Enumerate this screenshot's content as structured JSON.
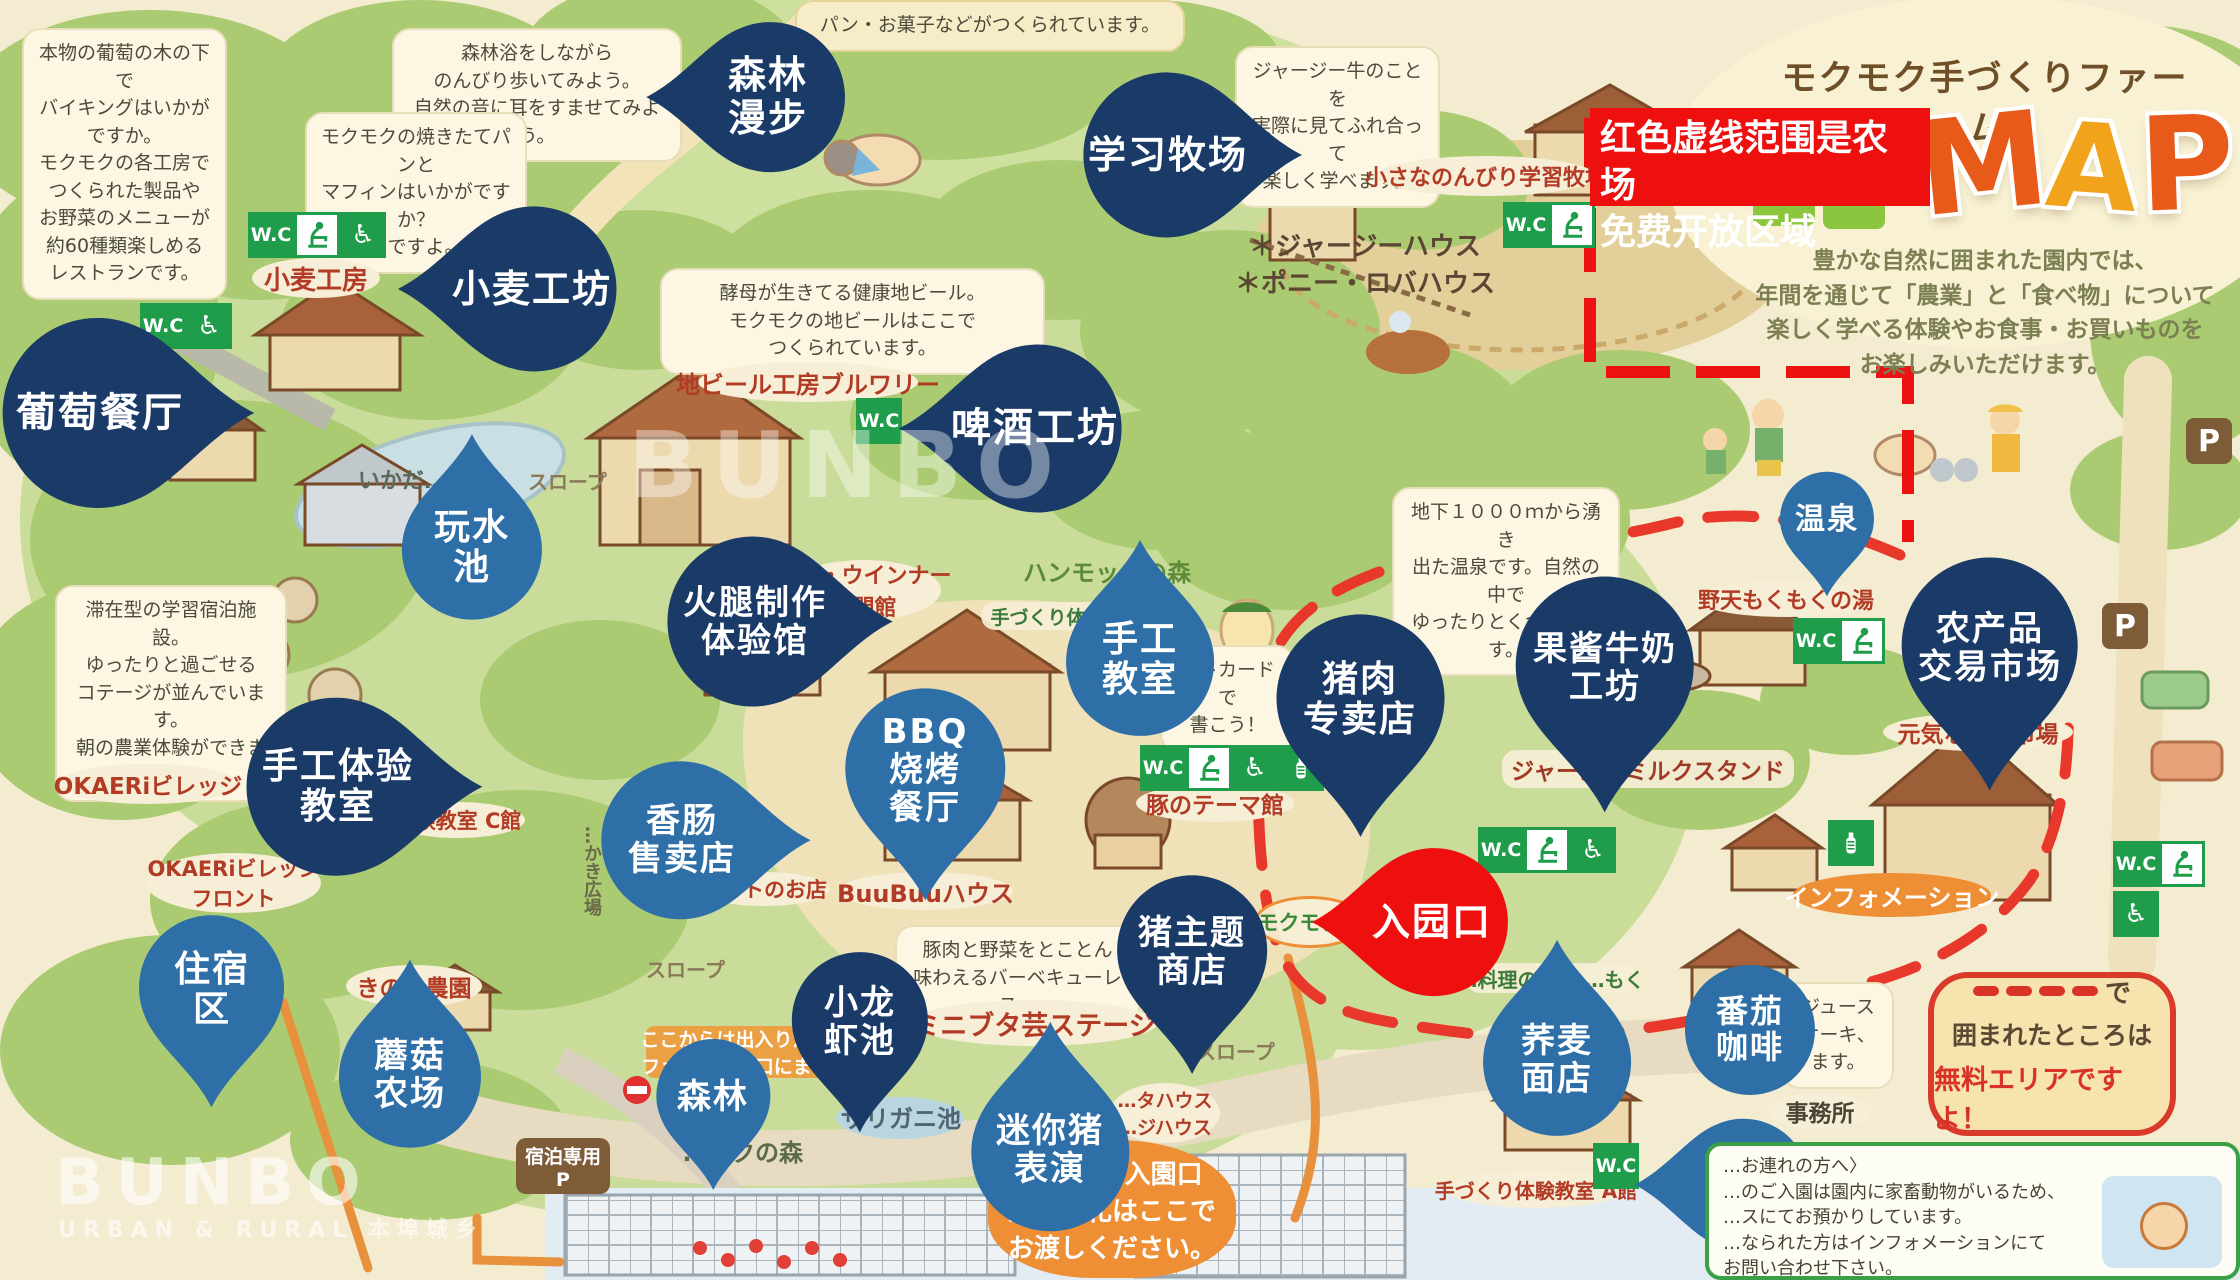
{
  "colors": {
    "pin_navy": "#1a3a68",
    "pin_light": "#2e6fa8",
    "pin_red": "#ee0f0f",
    "wc_green": "#1f9d4a",
    "orange": "#ef8f35",
    "map_red": "#e8372b",
    "cream": "#f4ecd1"
  },
  "title": {
    "farm": "モクモク手づくりファーム",
    "map_letters": [
      "M",
      "A",
      "P"
    ],
    "intro": [
      "豊かな自然に囲まれた園内では、",
      "年間を通じて「農業」と「食べ物」について",
      "楽しく学べる体験やお食事・お買いものを",
      "お楽しみいただけます。"
    ]
  },
  "red_notice": {
    "lines": [
      "红色虚线范围是农场",
      "免费开放区域"
    ]
  },
  "free_callout": {
    "line1_suffix": "で",
    "line2": "囲まれたところは",
    "line3": "無料エリアですよ！"
  },
  "pet_notice": {
    "lines": [
      "…お連れの方へ〉",
      "…のご入園は園内に家畜動物がいるため、",
      "…スにてお預かりしています。",
      "…なられた方はインフォメーションにて",
      "お問い合わせ下さい。"
    ]
  },
  "watermarks": {
    "center": "BUNBO",
    "corner": "BUNBO",
    "corner_sub": "URBAN & RURAL 本埠城乡"
  },
  "pins": [
    {
      "id": "grape-restaurant",
      "lines": [
        "葡萄餐厅"
      ],
      "cx": 100,
      "cy": 413,
      "d": 190,
      "dir": "right",
      "style": "navy",
      "fs": 40
    },
    {
      "id": "wheat-workshop",
      "lines": [
        "小麦工坊"
      ],
      "cx": 532,
      "cy": 289,
      "d": 165,
      "dir": "left",
      "style": "navy",
      "fs": 38
    },
    {
      "id": "forest-walk",
      "lines": [
        "森林",
        "漫步"
      ],
      "cx": 768,
      "cy": 97,
      "d": 150,
      "dir": "left",
      "style": "navy",
      "fs": 38
    },
    {
      "id": "learning-ranch",
      "lines": [
        "学习牧场"
      ],
      "cx": 1168,
      "cy": 155,
      "d": 165,
      "dir": "right",
      "style": "navy",
      "fs": 38
    },
    {
      "id": "beer-workshop",
      "lines": [
        "啤酒工坊"
      ],
      "cx": 1035,
      "cy": 428,
      "d": 168,
      "dir": "left",
      "style": "navy",
      "fs": 40
    },
    {
      "id": "ham-workshop",
      "lines": [
        "火腿制作",
        "体验馆"
      ],
      "cx": 755,
      "cy": 622,
      "d": 170,
      "dir": "right",
      "style": "navy",
      "fs": 34
    },
    {
      "id": "water-pond",
      "lines": [
        "玩水",
        "池"
      ],
      "cx": 472,
      "cy": 548,
      "d": 140,
      "dir": "up",
      "style": "light",
      "fs": 36
    },
    {
      "id": "craft-class-center",
      "lines": [
        "手工",
        "教室"
      ],
      "cx": 1140,
      "cy": 660,
      "d": 148,
      "dir": "up",
      "style": "light",
      "fs": 36
    },
    {
      "id": "bbq-restaurant",
      "lines": [
        "BBQ",
        "烧烤",
        "餐厅"
      ],
      "cx": 925,
      "cy": 770,
      "d": 160,
      "dir": "down",
      "style": "light",
      "fs": 34
    },
    {
      "id": "sausage-shop",
      "lines": [
        "香肠",
        "售卖店"
      ],
      "cx": 682,
      "cy": 840,
      "d": 158,
      "dir": "right",
      "style": "light",
      "fs": 34
    },
    {
      "id": "craft-experience-class",
      "lines": [
        "手工体验",
        "教室"
      ],
      "cx": 338,
      "cy": 787,
      "d": 178,
      "dir": "right",
      "style": "navy",
      "fs": 36
    },
    {
      "id": "pork-shop",
      "lines": [
        "猪肉",
        "专卖店"
      ],
      "cx": 1360,
      "cy": 700,
      "d": 168,
      "dir": "down",
      "style": "navy",
      "fs": 36
    },
    {
      "id": "jam-milk-workshop",
      "lines": [
        "果酱牛奶",
        "工坊"
      ],
      "cx": 1605,
      "cy": 668,
      "d": 178,
      "dir": "down",
      "style": "navy",
      "fs": 34
    },
    {
      "id": "hot-spring",
      "lines": [
        "温泉"
      ],
      "cx": 1827,
      "cy": 520,
      "d": 94,
      "dir": "down",
      "style": "light",
      "fs": 30
    },
    {
      "id": "farm-produce-market",
      "lines": [
        "农产品",
        "交易市场"
      ],
      "cx": 1990,
      "cy": 648,
      "d": 176,
      "dir": "down",
      "style": "navy",
      "fs": 34
    },
    {
      "id": "entrance",
      "lines": [
        "入园口"
      ],
      "cx": 1432,
      "cy": 922,
      "d": 148,
      "dir": "left",
      "style": "red",
      "fs": 38
    },
    {
      "id": "pig-theme-store",
      "lines": [
        "猪主题",
        "商店"
      ],
      "cx": 1192,
      "cy": 952,
      "d": 150,
      "dir": "down",
      "style": "navy",
      "fs": 34
    },
    {
      "id": "lodging-area",
      "lines": [
        "住宿",
        "区"
      ],
      "cx": 212,
      "cy": 990,
      "d": 145,
      "dir": "down",
      "style": "light",
      "fs": 36
    },
    {
      "id": "mushroom-farm",
      "lines": [
        "蘑菇",
        "农场"
      ],
      "cx": 410,
      "cy": 1075,
      "d": 142,
      "dir": "up",
      "style": "light",
      "fs": 34
    },
    {
      "id": "forest",
      "lines": [
        "森林"
      ],
      "cx": 713,
      "cy": 1097,
      "d": 114,
      "dir": "down",
      "style": "light",
      "fs": 34
    },
    {
      "id": "crayfish-pond",
      "lines": [
        "小龙",
        "虾池"
      ],
      "cx": 860,
      "cy": 1022,
      "d": 136,
      "dir": "down",
      "style": "navy",
      "fs": 34
    },
    {
      "id": "mini-pig-show",
      "lines": [
        "迷你猪",
        "表演"
      ],
      "cx": 1050,
      "cy": 1150,
      "d": 158,
      "dir": "up",
      "style": "light",
      "fs": 34
    },
    {
      "id": "soba-shop",
      "lines": [
        "荞麦",
        "面店"
      ],
      "cx": 1557,
      "cy": 1060,
      "d": 148,
      "dir": "up",
      "style": "light",
      "fs": 34
    },
    {
      "id": "tomato-coffee",
      "lines": [
        "番茄",
        "咖啡"
      ],
      "cx": 1750,
      "cy": 1030,
      "d": 130,
      "dir": "none",
      "style": "light",
      "fs": 32
    },
    {
      "id": "craft-class-br",
      "lines": [
        "手工",
        "教室"
      ],
      "cx": 1742,
      "cy": 1185,
      "d": 132,
      "dir": "left",
      "style": "light",
      "fs": 32
    }
  ],
  "bubbles": [
    {
      "x": 22,
      "y": 28,
      "w": 205,
      "tone": "cream",
      "lines": [
        "本物の葡萄の木の下で",
        "バイキングはいかがですか。",
        "モクモクの各工房で",
        "つくられた製品や",
        "お野菜のメニューが",
        "約60種類楽しめる",
        "レストランです。"
      ]
    },
    {
      "x": 392,
      "y": 28,
      "w": 290,
      "tone": "cream",
      "lines": [
        "森林浴をしながら",
        "のんびり歩いてみよう。",
        "自然の音に耳をすませてみよう。"
      ]
    },
    {
      "x": 795,
      "y": 0,
      "w": 390,
      "tone": "yellow",
      "lines": [
        "パン・お菓子などがつくられています。"
      ]
    },
    {
      "x": 305,
      "y": 112,
      "w": 222,
      "tone": "cream",
      "lines": [
        "モクモクの焼きたてパンと",
        "マフィンはいかがですか？",
        "…ですよ。"
      ]
    },
    {
      "x": 660,
      "y": 268,
      "w": 385,
      "tone": "cream",
      "lines": [
        "酵母が生きてる健康地ビール。",
        "モクモクの地ビールはここで",
        "つくられています。"
      ]
    },
    {
      "x": 1235,
      "y": 46,
      "w": 205,
      "tone": "cream",
      "lines": [
        "ジャージー牛のことを",
        "実際に見てふれ合って",
        "楽しく学べます。"
      ]
    },
    {
      "x": 55,
      "y": 585,
      "w": 232,
      "tone": "cream",
      "lines": [
        "滞在型の学習宿泊施設。",
        "ゆったりと過ごせる",
        "コテージが並んでいます。",
        "朝の農業体験ができます。"
      ]
    },
    {
      "x": 1392,
      "y": 487,
      "w": 228,
      "tone": "cream",
      "lines": [
        "地下１０００ｍから湧き",
        "出た温泉です。自然の中で",
        "ゆったりとくつろげます。"
      ]
    },
    {
      "x": 1160,
      "y": 645,
      "w": 135,
      "tone": "cream",
      "lines": [
        "ストカードで",
        "書こう！"
      ]
    },
    {
      "x": 895,
      "y": 925,
      "w": 245,
      "tone": "cream",
      "lines": [
        "豚肉と野菜をとことん",
        "味わえるバーベキューレス…"
      ]
    },
    {
      "x": 1782,
      "y": 982,
      "w": 112,
      "tone": "cream",
      "lines": [
        "ジュース",
        "ケーキ、",
        "ます。"
      ]
    }
  ],
  "labels": [
    {
      "type": "oval",
      "x": 252,
      "y": 258,
      "w": 128,
      "h": 40,
      "fs": 26,
      "lines": [
        "小麦工房"
      ]
    },
    {
      "type": "oval",
      "x": 698,
      "y": 362,
      "w": 220,
      "h": 40,
      "fs": 24,
      "lines": [
        "地ビール工房ブルワリー"
      ]
    },
    {
      "type": "oval",
      "x": 786,
      "y": 560,
      "w": 155,
      "h": 60,
      "fs": 22,
      "lines": [
        "ハム・ウインナー",
        "専門館"
      ]
    },
    {
      "type": "oval",
      "x": 1376,
      "y": 156,
      "w": 220,
      "h": 40,
      "fs": 22,
      "lines": [
        "小さなのんびり学習牧場"
      ]
    },
    {
      "type": "plain",
      "x": 1235,
      "y": 226,
      "fs": 26,
      "color": "#5a4632",
      "lines": [
        "＊ジャージーハウス",
        "＊ポニー・ロバハウス"
      ]
    },
    {
      "type": "oval",
      "x": 1696,
      "y": 581,
      "w": 180,
      "h": 36,
      "fs": 22,
      "lines": [
        "野天もくもくの湯"
      ]
    },
    {
      "type": "oval",
      "x": 1883,
      "y": 713,
      "w": 190,
      "h": 38,
      "fs": 23,
      "lines": [
        "元気な野菜市場"
      ]
    },
    {
      "type": "band",
      "x": 1502,
      "y": 750,
      "w": 292,
      "h": 38,
      "fs": 23,
      "lines": [
        "ジャージーミルクスタンド"
      ]
    },
    {
      "type": "oval",
      "x": 1136,
      "y": 784,
      "w": 158,
      "h": 38,
      "fs": 23,
      "lines": [
        "豚のテーマ館"
      ]
    },
    {
      "type": "oval",
      "x": 838,
      "y": 872,
      "w": 175,
      "h": 38,
      "fs": 24,
      "lines": [
        "BuuBuuハウス"
      ]
    },
    {
      "type": "oval",
      "x": 698,
      "y": 872,
      "w": 132,
      "h": 34,
      "fs": 21,
      "lines": [
        "フルトのお店"
      ]
    },
    {
      "type": "oval",
      "x": 390,
      "y": 802,
      "w": 135,
      "h": 36,
      "fs": 21,
      "lines": [
        "体験教室 C館"
      ]
    },
    {
      "type": "oval",
      "x": 1446,
      "y": 1170,
      "w": 180,
      "h": 38,
      "fs": 20,
      "lines": [
        "手づくり体験教室 A館"
      ]
    },
    {
      "type": "oval",
      "x": 58,
      "y": 764,
      "w": 180,
      "h": 40,
      "fs": 23,
      "lines": [
        "OKAERiビレッジ"
      ]
    },
    {
      "type": "oval",
      "x": 146,
      "y": 853,
      "w": 175,
      "h": 60,
      "fs": 21,
      "lines": [
        "OKAERiビレッジ",
        "フロント"
      ]
    },
    {
      "type": "oval",
      "x": 346,
      "y": 965,
      "w": 136,
      "h": 42,
      "fs": 23,
      "lines": [
        "きのこ農園"
      ]
    },
    {
      "type": "oval",
      "x": 912,
      "y": 1000,
      "w": 245,
      "h": 46,
      "fs": 27,
      "lines": [
        "ミニブタ芸ステージ"
      ]
    },
    {
      "type": "oval",
      "x": 1110,
      "y": 1083,
      "w": 110,
      "h": 60,
      "fs": 19,
      "lines": [
        "…タハウス",
        "…ジハウス"
      ]
    },
    {
      "type": "cband",
      "x": 1466,
      "y": 963,
      "w": 170,
      "h": 30,
      "fs": 20,
      "lines": [
        "…料理のお店 …もく"
      ]
    },
    {
      "type": "oval",
      "x": 1768,
      "y": 1093,
      "w": 104,
      "h": 36,
      "fs": 23,
      "color": "#4a4436",
      "lines": [
        "事務所"
      ]
    },
    {
      "type": "orange-oval",
      "x": 1793,
      "y": 873,
      "w": 198,
      "h": 44,
      "fs": 24,
      "lines": [
        "インフォメーション"
      ]
    },
    {
      "type": "orange-banner",
      "x": 646,
      "y": 1026,
      "w": 236,
      "h": 52,
      "fs": 19,
      "lines": [
        "ここからは出入りができま…",
        "ファーム入園口にまわって…"
      ]
    },
    {
      "type": "orange-blob",
      "x": 988,
      "y": 1140,
      "w": 248,
      "h": 138,
      "fs": 26,
      "lines": [
        "ファーム入園口",
        "入園木札はここで",
        "お渡しください。"
      ]
    },
    {
      "type": "brown",
      "x": 516,
      "y": 1138,
      "w": 94,
      "h": 56,
      "fs": 19,
      "lines": [
        "宿泊専用",
        "P"
      ]
    },
    {
      "type": "pp",
      "x": 2186,
      "y": 418,
      "w": 46,
      "h": 46,
      "fs": 30,
      "lines": [
        "P"
      ]
    },
    {
      "type": "pp",
      "x": 2102,
      "y": 603,
      "w": 46,
      "h": 46,
      "fs": 30,
      "lines": [
        "P"
      ]
    },
    {
      "type": "plain",
      "x": 1023,
      "y": 553,
      "fs": 24,
      "color": "#5e8a3c",
      "lines": [
        "ハンモックの森"
      ]
    },
    {
      "type": "plain",
      "x": 683,
      "y": 1133,
      "fs": 24,
      "color": "#5a6a48",
      "lines": [
        "…ックの森"
      ]
    },
    {
      "type": "plain",
      "x": 841,
      "y": 1099,
      "fs": 24,
      "color": "#4f6470",
      "lines": [
        "ザリガニ池"
      ]
    },
    {
      "type": "plain",
      "x": 528,
      "y": 466,
      "fs": 20,
      "color": "#8a7a5a",
      "lines": [
        "スロープ"
      ]
    },
    {
      "type": "plain",
      "x": 646,
      "y": 954,
      "fs": 20,
      "color": "#8a7a5a",
      "lines": [
        "スロープ"
      ]
    },
    {
      "type": "plain",
      "x": 1196,
      "y": 1036,
      "fs": 20,
      "color": "#8a7a5a",
      "lines": [
        "スロープ"
      ]
    },
    {
      "type": "plain",
      "x": 358,
      "y": 463,
      "fs": 22,
      "color": "#5a6a5a",
      "lines": [
        "いかだ…"
      ]
    },
    {
      "type": "vert",
      "x": 578,
      "y": 826,
      "fs": 18,
      "color": "#6a6a4a",
      "lines": [
        "…かき広場"
      ]
    },
    {
      "type": "oval-orange-border",
      "x": 1254,
      "y": 896,
      "w": 112,
      "h": 52,
      "fs": 21,
      "lines": [
        "モクモク…"
      ]
    },
    {
      "type": "cband",
      "x": 981,
      "y": 602,
      "w": 152,
      "h": 28,
      "fs": 19,
      "lines": [
        "手づくり体験…"
      ]
    }
  ],
  "wc_signs": [
    {
      "x": 248,
      "y": 212,
      "cells": [
        "wc",
        "baby",
        "wheel"
      ]
    },
    {
      "x": 140,
      "y": 303,
      "cells": [
        "wc",
        "wheel"
      ]
    },
    {
      "x": 856,
      "y": 398,
      "cells": [
        "wc"
      ]
    },
    {
      "x": 1503,
      "y": 202,
      "cells": [
        "wc",
        "baby"
      ]
    },
    {
      "x": 1140,
      "y": 745,
      "cells": [
        "wc",
        "baby",
        "wheel",
        "bottle"
      ]
    },
    {
      "x": 1478,
      "y": 827,
      "cells": [
        "wc",
        "baby",
        "wheel"
      ]
    },
    {
      "x": 1793,
      "y": 618,
      "cells": [
        "wc",
        "baby"
      ]
    },
    {
      "x": 2113,
      "y": 841,
      "cells": [
        "wc",
        "baby"
      ]
    },
    {
      "x": 2113,
      "y": 891,
      "cells": [
        "wheel"
      ]
    },
    {
      "x": 1593,
      "y": 1143,
      "cells": [
        "wc"
      ]
    },
    {
      "x": 1828,
      "y": 820,
      "cells": [
        "bottle"
      ]
    }
  ]
}
